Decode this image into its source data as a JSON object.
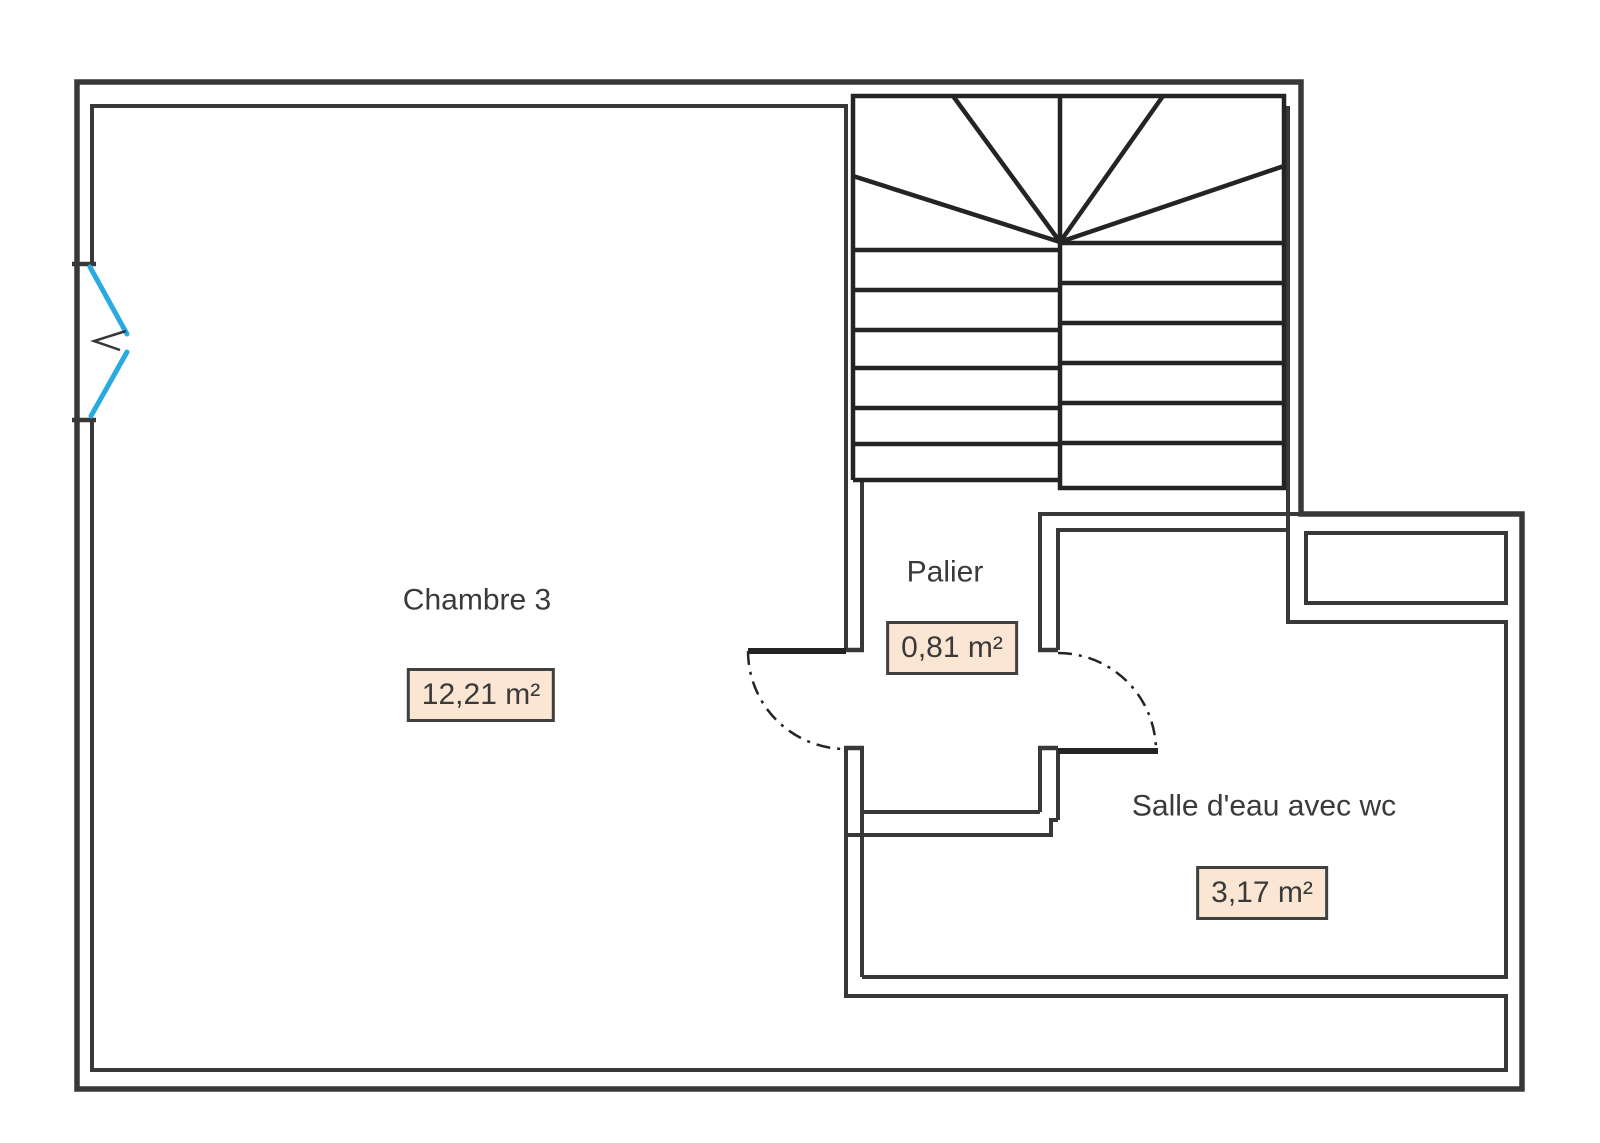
{
  "plan": {
    "rooms": [
      {
        "id": "chambre3",
        "name": "Chambre 3",
        "area": "12,21 m²"
      },
      {
        "id": "palier",
        "name": "Palier",
        "area": "0,81 m²"
      },
      {
        "id": "salle-eau",
        "name": "Salle d'eau avec wc",
        "area": "3,17 m²"
      }
    ],
    "colors": {
      "background": "#ffffff",
      "wall": "#383838",
      "stair": "#242424",
      "window": "#29ABE2",
      "area_box_fill": "#fbe5d3",
      "area_box_border": "#404040",
      "text": "#3a3a3a"
    }
  }
}
